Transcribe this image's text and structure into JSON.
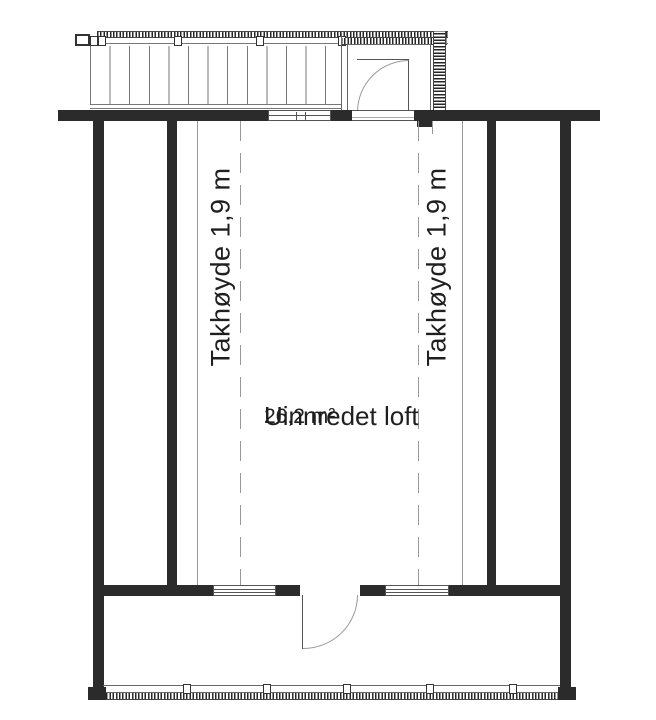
{
  "plan": {
    "room_name": "Uinnredet loft",
    "room_area": "26,2 m²",
    "ceiling_height_left": "Takhøyde 1,9 m",
    "ceiling_height_right": "Takhøyde 1,9 m"
  },
  "colors": {
    "wall": "#2b2b2b",
    "thin": "#777777",
    "mid": "#555555",
    "light": "#999999",
    "text": "#1f1f1f",
    "bg": "#ffffff"
  }
}
